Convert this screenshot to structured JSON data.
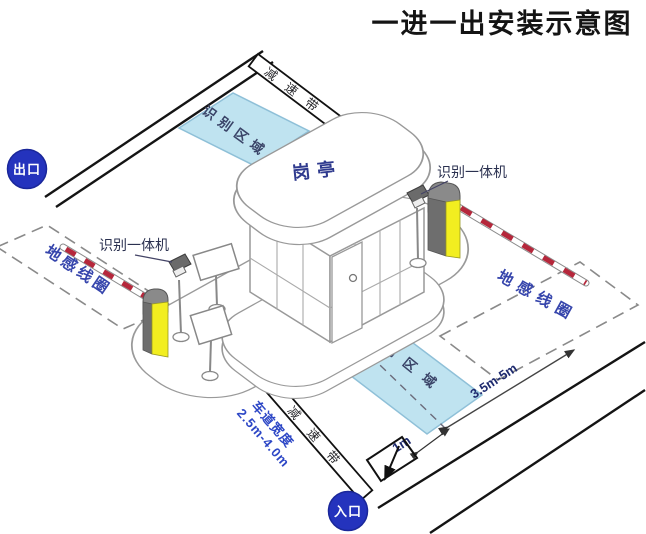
{
  "title": "一进一出安装示意图",
  "badges": {
    "exit": "出口",
    "entrance": "入口"
  },
  "booth": {
    "label": "岗亭"
  },
  "labels": {
    "camera": "识别一体机",
    "recognition_area": "识别区域",
    "speed_bump": "减速带",
    "ground_coil": "地感线圈",
    "lane_width_title": "车道宽度",
    "lane_width_value": "2.5m-4.0m",
    "coil_distance": "3.5m-5m",
    "center_offset": "1m"
  },
  "colors": {
    "badge_blue": "#2433bd",
    "area_fill": "#bfe3f0",
    "area_stroke": "#8fc0d8",
    "machine_yellow": "#f2ee20",
    "arm_red": "#b5273b",
    "coil_text_blue": "#3645ac",
    "lane_text_blue": "#2d47c6",
    "dim_navy": "#1e2a6e",
    "road_black": "#141414",
    "outline_gray": "#999999"
  }
}
